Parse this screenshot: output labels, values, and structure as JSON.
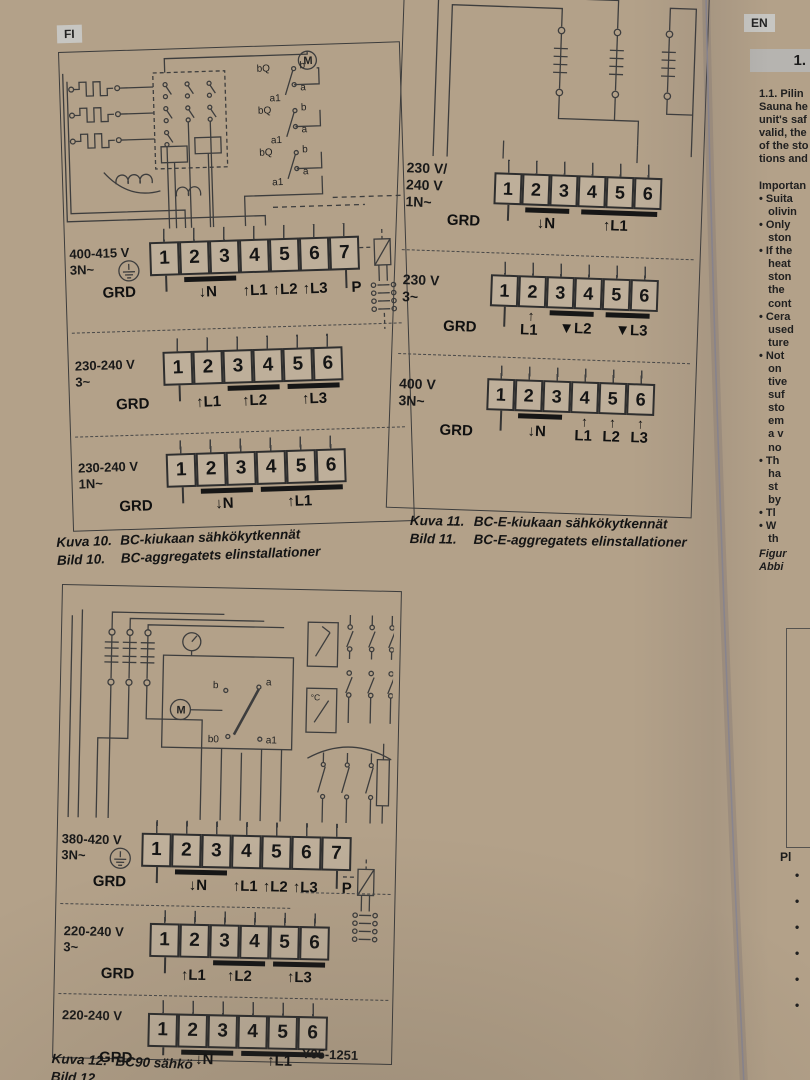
{
  "colors": {
    "paper": "#e8e6e1",
    "table": "#b3a189",
    "ink": "#2e2e2e"
  },
  "badges": {
    "fi": "FI",
    "en": "EN"
  },
  "icons": {
    "up": "↑",
    "down": "↓",
    "down_filled": "▼"
  },
  "figure10": {
    "schematic_labels": {
      "motor": "M",
      "coil": "bQ",
      "sub": "a1",
      "top": "b",
      "bottom": "a"
    },
    "rows": [
      {
        "voltage": "400-415 V",
        "system": "3N~",
        "terminals": [
          "1",
          "2",
          "3",
          "4",
          "5",
          "6",
          "7"
        ],
        "ground": "GRD",
        "n": "N",
        "l1": "L1",
        "l2": "L2",
        "l3": "L3",
        "p": "P"
      },
      {
        "voltage": "230-240 V",
        "system": "3~",
        "terminals": [
          "1",
          "2",
          "3",
          "4",
          "5",
          "6"
        ],
        "ground": "GRD",
        "l1": "L1",
        "l2": "L2",
        "l3": "L3"
      },
      {
        "voltage": "230-240 V",
        "system": "1N~",
        "terminals": [
          "1",
          "2",
          "3",
          "4",
          "5",
          "6"
        ],
        "ground": "GRD",
        "n": "N",
        "l1": "L1"
      }
    ],
    "caption": {
      "fi_label": "Kuva 10.",
      "fi_text": "BC-kiukaan sähkökytkennät",
      "sv_label": "Bild 10.",
      "sv_text": "BC-aggregatets elinstallationer"
    }
  },
  "figure11": {
    "rows": [
      {
        "voltage_line1": "230 V/",
        "voltage_line2": "240 V",
        "system": "1N~",
        "terminals": [
          "1",
          "2",
          "3",
          "4",
          "5",
          "6"
        ],
        "ground": "GRD",
        "n": "N",
        "l1": "L1"
      },
      {
        "voltage_line1": "230 V",
        "system": "3~",
        "terminals": [
          "1",
          "2",
          "3",
          "4",
          "5",
          "6"
        ],
        "ground": "GRD",
        "l1": "L1",
        "l2": "L2",
        "l3": "L3"
      },
      {
        "voltage_line1": "400 V",
        "system": "3N~",
        "terminals": [
          "1",
          "2",
          "3",
          "4",
          "5",
          "6"
        ],
        "ground": "GRD",
        "n": "N",
        "l1": "L1",
        "l2": "L2",
        "l3": "L3"
      }
    ],
    "caption": {
      "fi_label": "Kuva 11.",
      "fi_text": "BC-E-kiukaan sähkökytkennät",
      "sv_label": "Bild 11.",
      "sv_text": "BC-E-aggregatets elinstallationer"
    }
  },
  "figure12": {
    "schematic_labels": {
      "motor": "M",
      "b": "b",
      "a": "a",
      "b0": "b0",
      "a1": "a1",
      "temp": "°C"
    },
    "rows": [
      {
        "voltage": "380-420 V",
        "system": "3N~",
        "terminals": [
          "1",
          "2",
          "3",
          "4",
          "5",
          "6",
          "7"
        ],
        "ground": "GRD",
        "n": "N",
        "l1": "L1",
        "l2": "L2",
        "l3": "L3",
        "p": "P"
      },
      {
        "voltage": "220-240 V",
        "system": "3~",
        "terminals": [
          "1",
          "2",
          "3",
          "4",
          "5",
          "6"
        ],
        "ground": "GRD",
        "l1": "L1",
        "l2": "L2",
        "l3": "L3"
      },
      {
        "voltage": "220-240 V",
        "system": "",
        "terminals": [
          "1",
          "2",
          "3",
          "4",
          "5",
          "6"
        ],
        "ground": "GRD",
        "n": "N",
        "l1": "L1"
      }
    ],
    "caption": {
      "fi_label": "Kuva 12.",
      "fi_text": "BC90 sähkö",
      "sv_label": "Bild 12."
    },
    "drawing_code": "Y05-1251"
  },
  "en_page": {
    "section": "1.",
    "lines": [
      "1.1. Pilin",
      "Sauna he",
      "unit's saf",
      "valid, the",
      "of the sto",
      "tions and",
      "",
      "Importan",
      "• Suita",
      "   olivin",
      "• Only",
      "   ston",
      "• If the",
      "   heat",
      "   ston",
      "   the",
      "   cont",
      "• Cera",
      "   used",
      "   ture",
      "• Not",
      "   on",
      "   tive",
      "   suf",
      "   sto",
      "   em",
      "   a v",
      "   no",
      "• Th",
      "   ha",
      "   st",
      "   by",
      "• Tl",
      "• W",
      "   th"
    ],
    "figure_ref1": "Figur",
    "figure_ref2": "Abbi",
    "note_heading": "Pl",
    "margin_bullets": [
      "•",
      "•",
      "•",
      "•",
      "•",
      "•"
    ]
  }
}
